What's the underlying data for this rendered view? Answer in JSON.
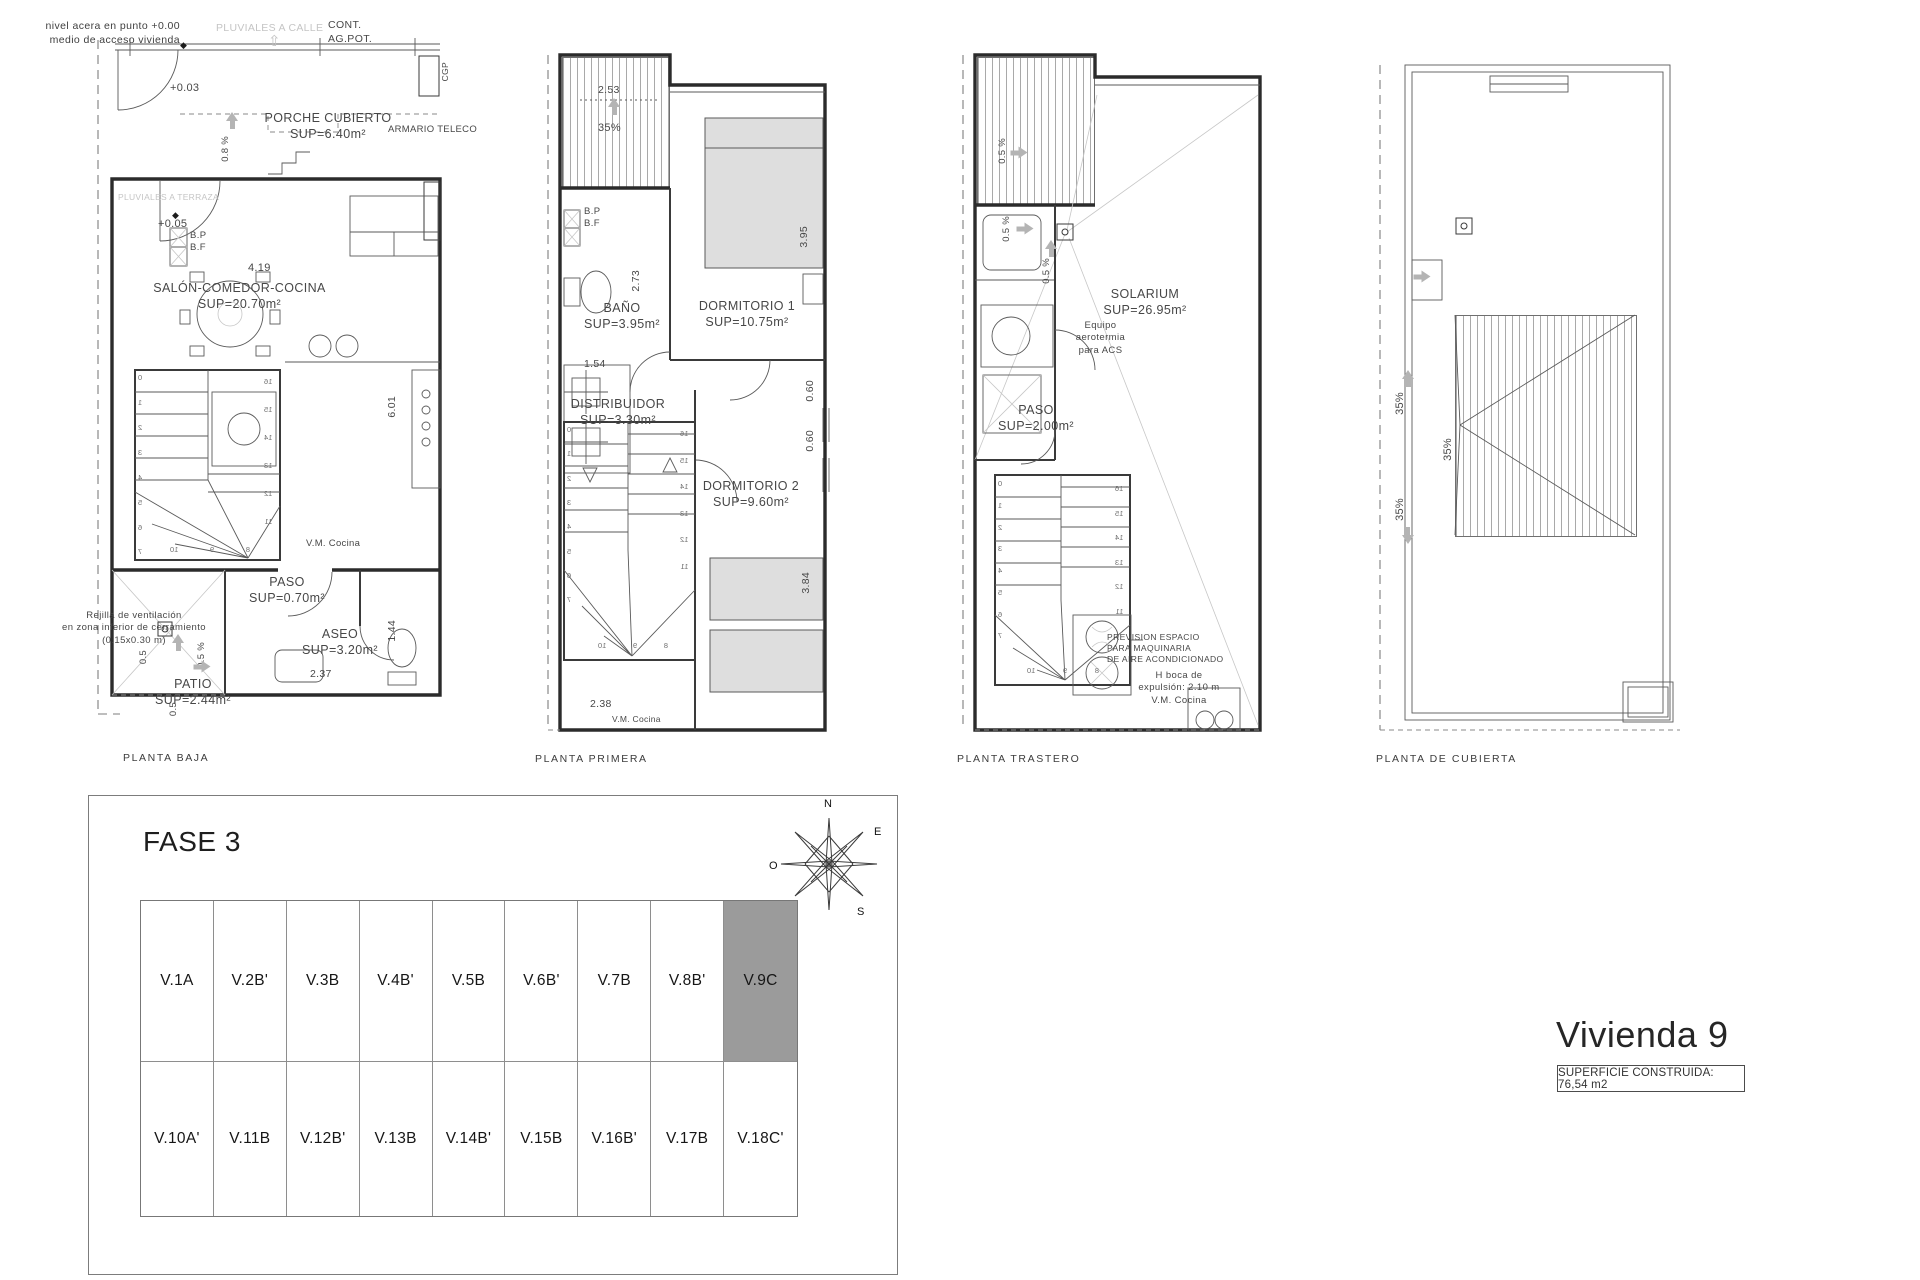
{
  "plans": [
    {
      "caption": "PLANTA BAJA",
      "labels": {
        "nivel1": "nivel acera en punto +0.00",
        "nivel2": "medio de acceso vivienda",
        "pluviales_calle": "PLUVIALES A CALLE",
        "cont": "CONT.",
        "agpot": "AG.POT.",
        "cgp": "CGP",
        "cota03": "+0.03",
        "porche": "PORCHE CUBIERTO",
        "porche_sup": "SUP=6.40m²",
        "pend08": "0.8 %",
        "armario": "ARMARIO TELECO",
        "pluviales_terraza": "PLUVIALES A TERRAZA",
        "cota05": "+0.05",
        "bp": "B.P",
        "bf": "B.F",
        "dim419": "4.19",
        "salon": "SALÓN-COMEDOR-COCINA",
        "salon_sup": "SUP=20.70m²",
        "dim601": "6.01",
        "vmcocina": "V.M. Cocina",
        "paso": "PASO",
        "paso_sup": "SUP=0.70m²",
        "rejilla1": "Rejilla de ventilación",
        "rejilla2": "en zona inferior de cerramiento",
        "rejilla3": "(0.15x0.30 m)",
        "pend05a": "0.5",
        "pend05b": "0.5 %",
        "pend05c": "0.5",
        "patio": "PATIO",
        "patio_sup": "SUP=2.44m²",
        "aseo": "ASEO",
        "aseo_sup": "SUP=3.20m²",
        "dim237": "2.37",
        "dim144": "1.44"
      },
      "stairs": {
        "left": [
          "0",
          "1",
          "2",
          "3",
          "4",
          "5",
          "6",
          "7"
        ],
        "right": [
          "16",
          "15",
          "14",
          "13",
          "12",
          "11"
        ],
        "bottom": [
          "8",
          "9",
          "10"
        ]
      }
    },
    {
      "caption": "PLANTA PRIMERA",
      "labels": {
        "slope": "35%",
        "dim253": "2.53",
        "bp": "B.P",
        "bf": "B.F",
        "dim273": "2.73",
        "bano": "BAÑO",
        "bano_sup": "SUP=3.95m²",
        "dim154": "1.54",
        "dorm1": "DORMITORIO 1",
        "dorm1_sup": "SUP=10.75m²",
        "dim395": "3.95",
        "distribuidor": "DISTRIBUIDOR",
        "distribuidor_sup": "SUP=3.30m²",
        "dim060a": "0.60",
        "dim060b": "0.60",
        "dorm2": "DORMITORIO 2",
        "dorm2_sup": "SUP=9.60m²",
        "dim384": "3.84",
        "dim238": "2.38",
        "vmcocina": "V.M. Cocina"
      },
      "stairs": {
        "left": [
          "0",
          "1",
          "2",
          "3",
          "4",
          "5",
          "6",
          "7"
        ],
        "right": [
          "16",
          "15",
          "14",
          "13",
          "12",
          "11"
        ],
        "bottom": [
          "8",
          "9",
          "10"
        ]
      }
    },
    {
      "caption": "PLANTA TRASTERO",
      "labels": {
        "pend05a": "0.5 %",
        "pend05b": "0.5 %",
        "pend05c": "0.5 %",
        "solarium": "SOLARIUM",
        "solarium_sup": "SUP=26.95m²",
        "equipo1": "Equipo",
        "equipo2": "aerotermia",
        "equipo3": "para ACS",
        "paso": "PASO",
        "paso_sup": "SUP=2.00m²",
        "prevision1": "PREVISION ESPACIO",
        "prevision2": "PARA MAQUINARIA",
        "prevision3": "DE AIRE ACONDICIONADO",
        "boca1": "H boca de",
        "boca2": "expulsión: 2.10 m",
        "boca3": "V.M. Cocina"
      },
      "stairs": {
        "left": [
          "0",
          "1",
          "2",
          "3",
          "4",
          "5",
          "6",
          "7"
        ],
        "right": [
          "16",
          "15",
          "14",
          "13",
          "12",
          "11"
        ],
        "bottom": [
          "8",
          "9",
          "10"
        ]
      }
    },
    {
      "caption": "PLANTA DE CUBIERTA",
      "labels": {
        "slope_a": "35%",
        "slope_b": "35%",
        "slope_c": "35%"
      }
    }
  ],
  "fase": {
    "title": "FASE 3",
    "compass": {
      "n": "N",
      "e": "E",
      "o": "O",
      "s": "S"
    },
    "units_row1": [
      "V.1A",
      "V.2B'",
      "V.3B",
      "V.4B'",
      "V.5B",
      "V.6B'",
      "V.7B",
      "V.8B'",
      "V.9C"
    ],
    "units_row2": [
      "V.10A'",
      "V.11B",
      "V.12B'",
      "V.13B",
      "V.14B'",
      "V.15B",
      "V.16B'",
      "V.17B",
      "V.18C'"
    ],
    "highlighted_unit": "V.9C",
    "highlight_color": "#9b9b9b"
  },
  "vivienda": {
    "title": "Vivienda 9",
    "superficie": "SUPERFICIE CONSTRUIDA: 76,54 m2"
  }
}
